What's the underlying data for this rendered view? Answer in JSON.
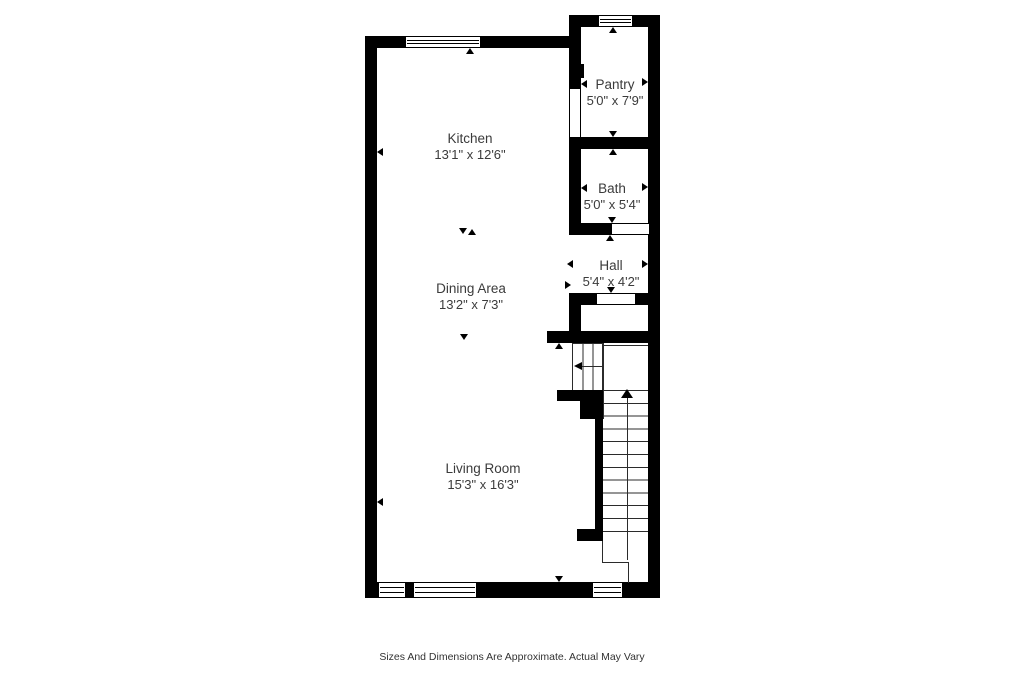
{
  "plan": {
    "title": "floor-plan",
    "rooms": {
      "kitchen": {
        "name": "Kitchen",
        "dims": "13'1\" x 12'6\""
      },
      "pantry": {
        "name": "Pantry",
        "dims": "5'0\" x 7'9\""
      },
      "bath": {
        "name": "Bath",
        "dims": "5'0\" x 5'4\""
      },
      "hall": {
        "name": "Hall",
        "dims": "5'4\" x 4'2\""
      },
      "dining": {
        "name": "Dining Area",
        "dims": "13'2\" x 7'3\""
      },
      "living": {
        "name": "Living Room",
        "dims": "15'3\" x 16'3\""
      }
    },
    "stairs": {
      "up_arrow_direction": "up",
      "exit_arrow_direction": "left",
      "tread_count": 12
    },
    "features": {
      "windows": [
        "kitchen-top",
        "pantry-top",
        "living-bottom-left-small",
        "living-bottom-left-large",
        "entry-bottom-right"
      ],
      "doors": [
        "pantry-side-opening",
        "bath-bottom-opening",
        "hall-bottom-opening"
      ]
    },
    "colors": {
      "wall": "#000000",
      "text": "#3b3b3b",
      "background": "#ffffff",
      "stair_line": "#2b2b2b"
    }
  },
  "footer": {
    "disclaimer": "Sizes And Dimensions Are Approximate. Actual May Vary"
  }
}
